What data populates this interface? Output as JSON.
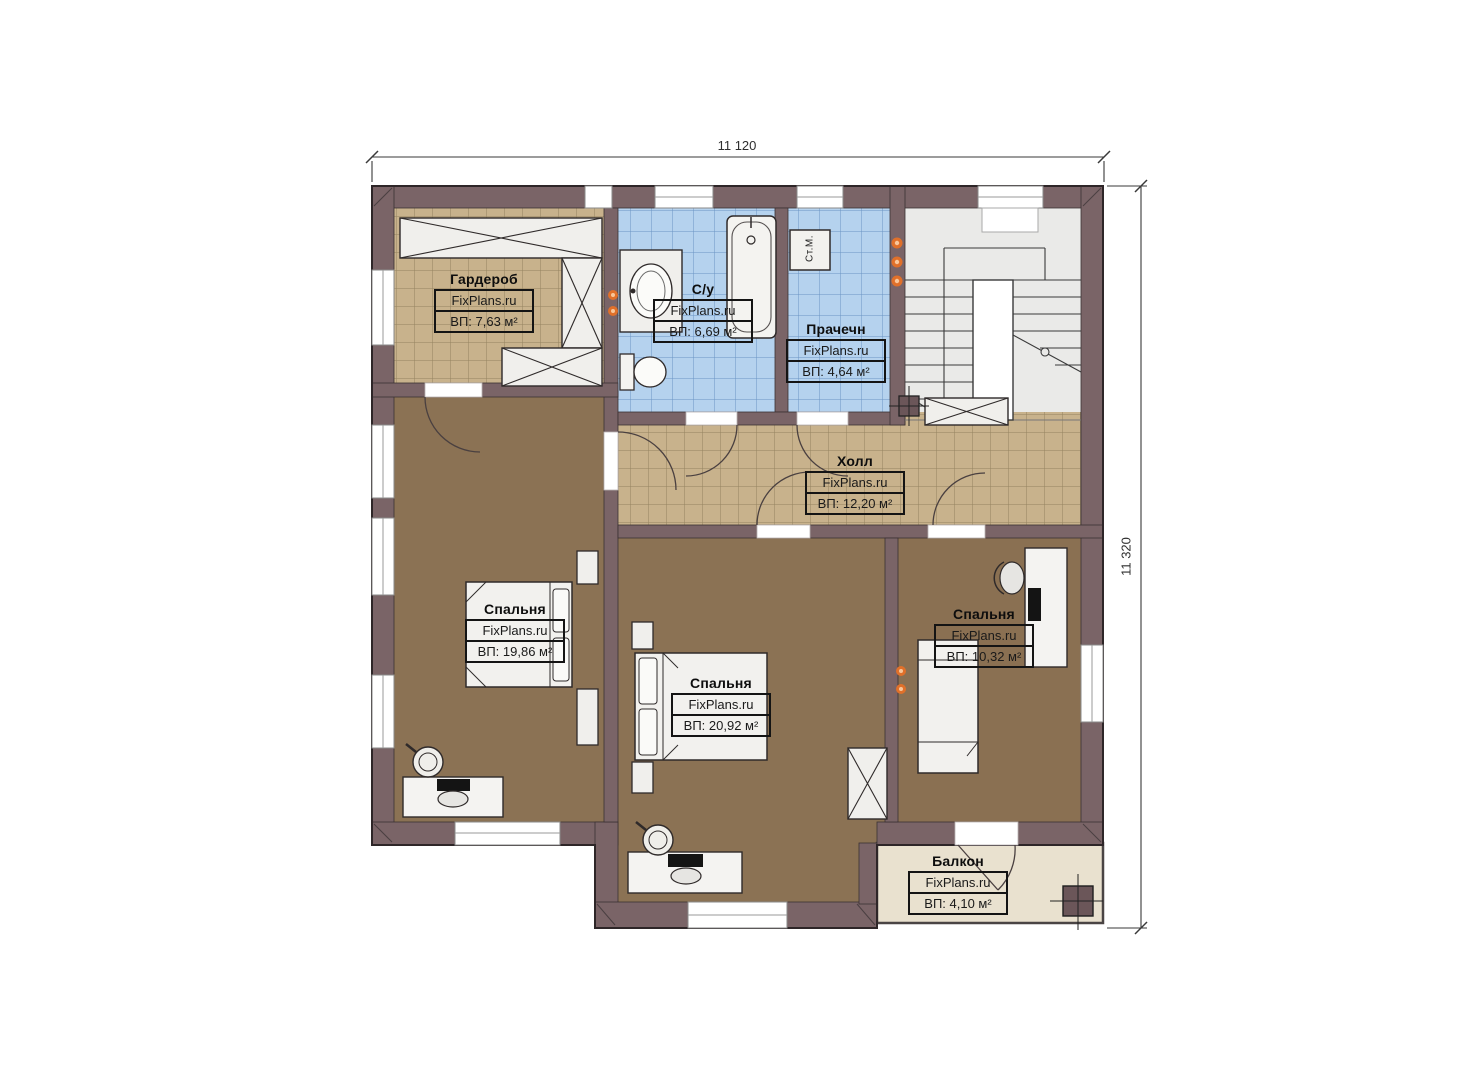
{
  "watermark": "FixPlans.ru",
  "dimensions": {
    "top": "11 120",
    "right": "11 320"
  },
  "rooms": [
    {
      "id": "garderob",
      "name": "Гардероб",
      "area": "ВП: 7,63 м²"
    },
    {
      "id": "bathroom",
      "name": "С/у",
      "area": "ВП: 6,69 м²"
    },
    {
      "id": "laundry",
      "name": "Прачечн",
      "area": "ВП: 4,64 м²"
    },
    {
      "id": "hall",
      "name": "Холл",
      "area": "ВП: 12,20 м²"
    },
    {
      "id": "bedroom-left",
      "name": "Спальня",
      "area": "ВП: 19,86 м²"
    },
    {
      "id": "bedroom-middle",
      "name": "Спальня",
      "area": "ВП: 20,92 м²"
    },
    {
      "id": "bedroom-right",
      "name": "Спальня",
      "area": "ВП: 10,32 м²"
    },
    {
      "id": "balcony",
      "name": "Балкон",
      "area": "ВП: 4,10 м²"
    }
  ],
  "labels": {
    "washing_machine": "Ст.М."
  },
  "colors": {
    "wall": "#7a6467",
    "tile_tan": "#c8b28c",
    "tile_blue": "#b5d2ee",
    "floor_brown": "#8b7254",
    "floor_balcony": "#e9e1cf",
    "radiator_dot": "#e0702a"
  }
}
